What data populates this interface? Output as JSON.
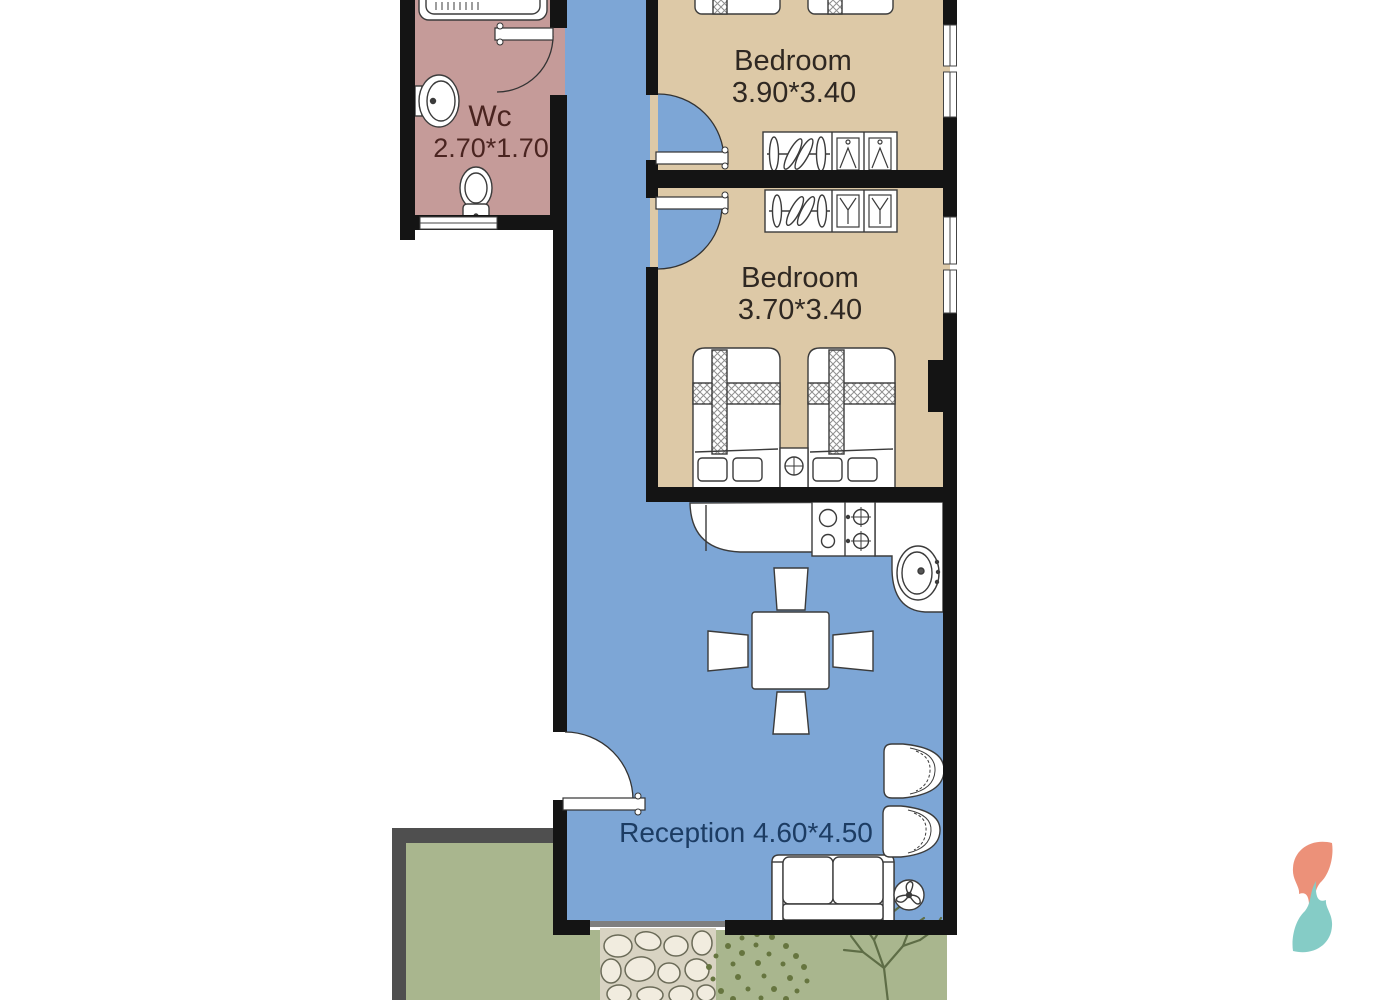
{
  "plan": {
    "type": "apartment-floorplan",
    "rooms": {
      "wc": {
        "label": "Wc",
        "dims": "2.70*1.70",
        "color": "#c59b99"
      },
      "bedroom1": {
        "label": "Bedroom",
        "dims": "3.90*3.40",
        "color": "#ddc9a7"
      },
      "bedroom2": {
        "label": "Bedroom",
        "dims": "3.70*3.40",
        "color": "#ddc9a7"
      },
      "reception": {
        "label": "Reception 4.60*4.50",
        "color": "#7da6d6"
      },
      "garden": {
        "color": "#a9b68e"
      }
    },
    "colors": {
      "wall": "#141414",
      "fence_gray": "#4f4f4f",
      "corridor_blue": "#7da6d6",
      "bedroom_tan": "#ddc9a7",
      "wc_pink": "#c59b99",
      "garden_green": "#a9b68e",
      "wc_text": "#4a2420",
      "bedroom_text": "#2f2822",
      "reception_text": "#1c3c63",
      "logo_coral": "#ec9179",
      "logo_teal": "#85ccc6"
    }
  }
}
